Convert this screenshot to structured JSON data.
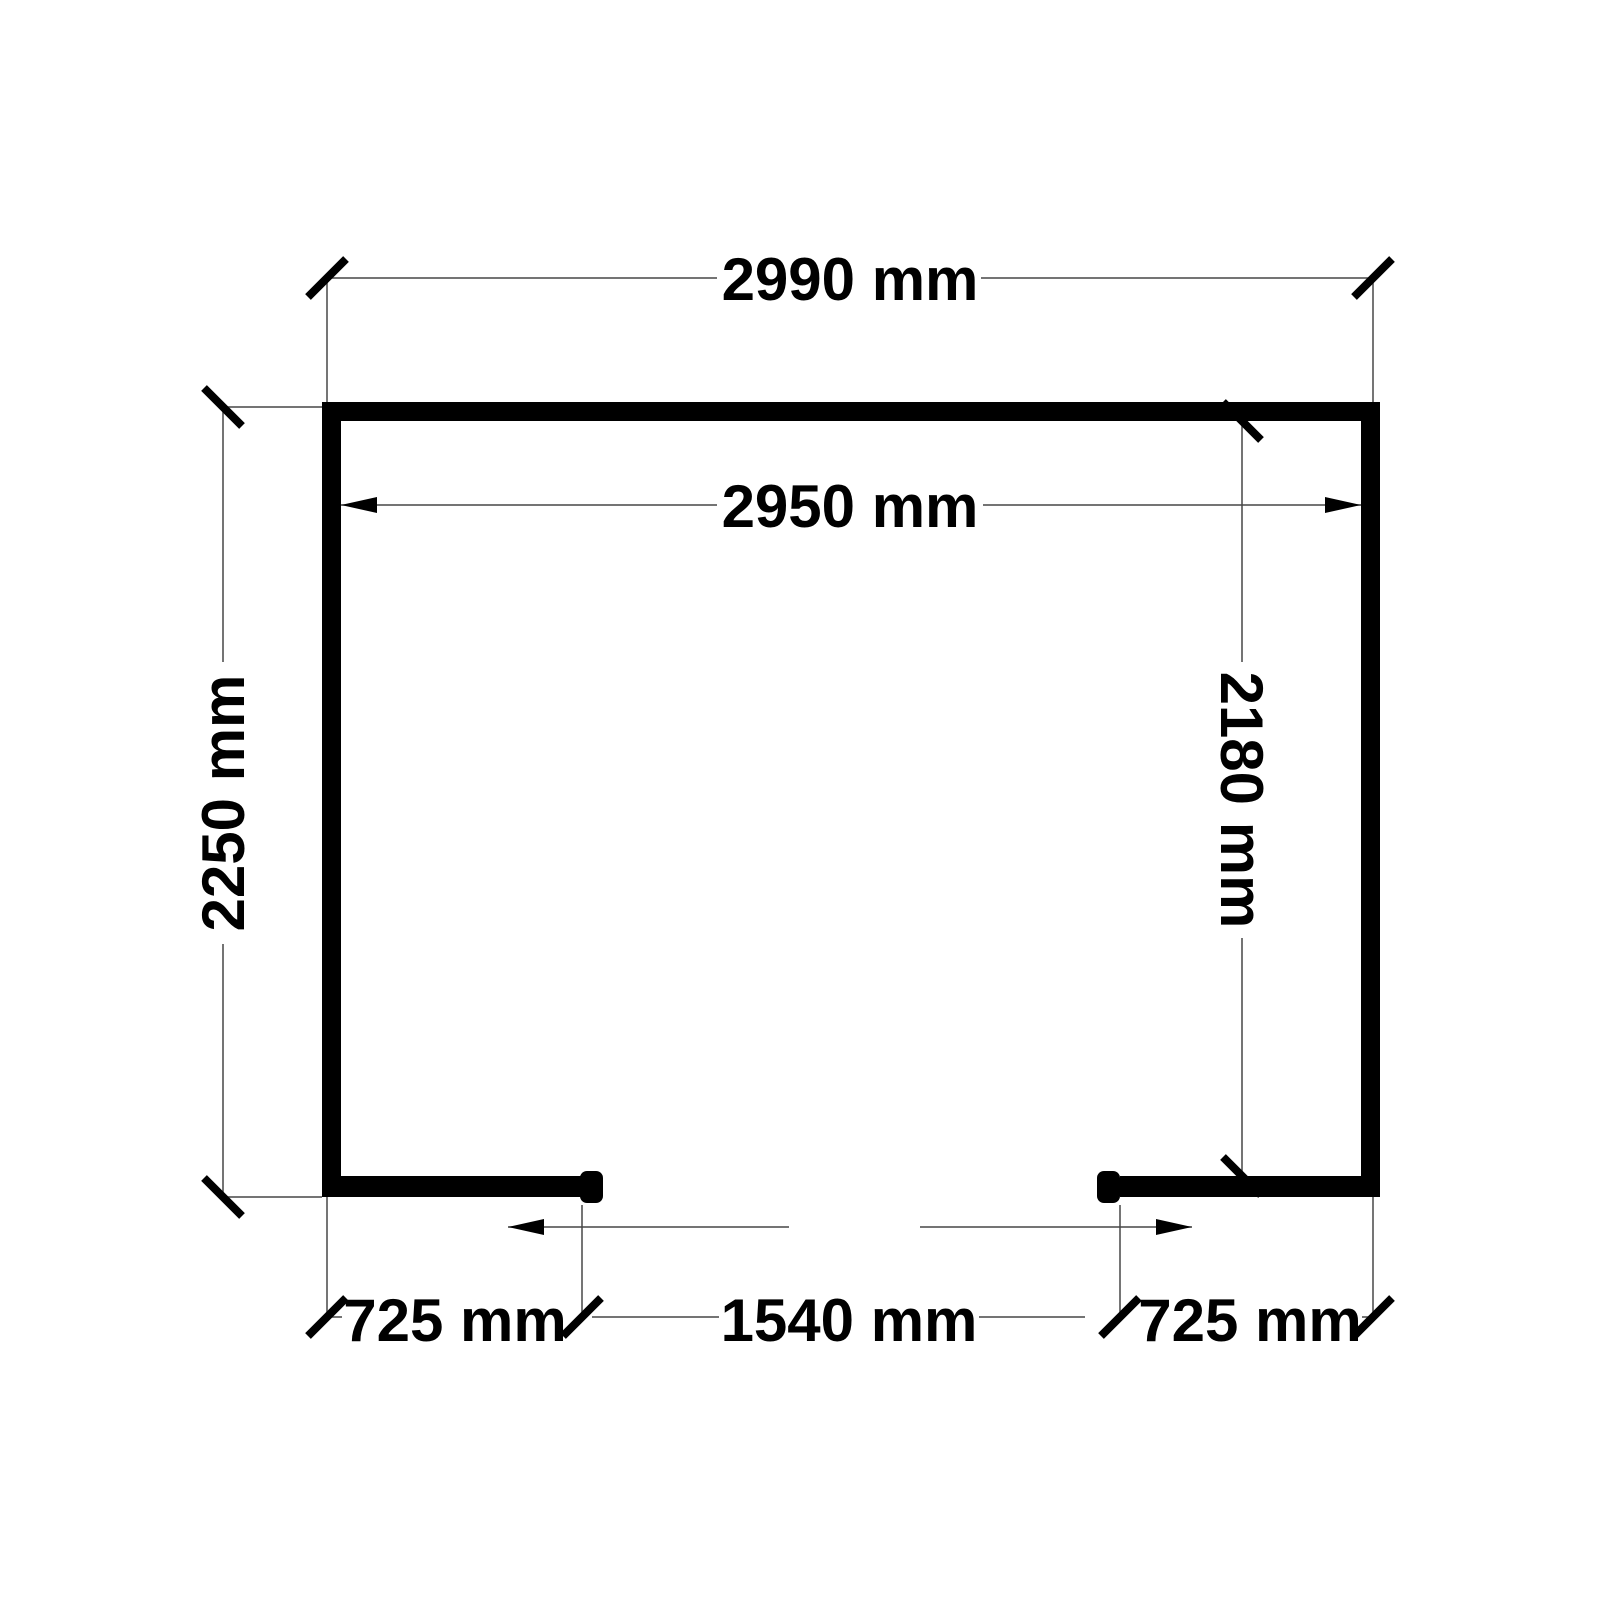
{
  "drawing": {
    "type": "floor-plan",
    "units": "mm",
    "colors": {
      "background": "#ffffff",
      "walls": "#000000",
      "dimension_lines": "#474747",
      "text": "#000000"
    },
    "dimensions": {
      "overall_width": "2990 mm",
      "inner_width": "2950 mm",
      "overall_depth": "2250 mm",
      "inner_depth": "2180 mm",
      "opening_width": "1540 mm",
      "left_segment": "725 mm",
      "right_segment": "725 mm"
    }
  }
}
